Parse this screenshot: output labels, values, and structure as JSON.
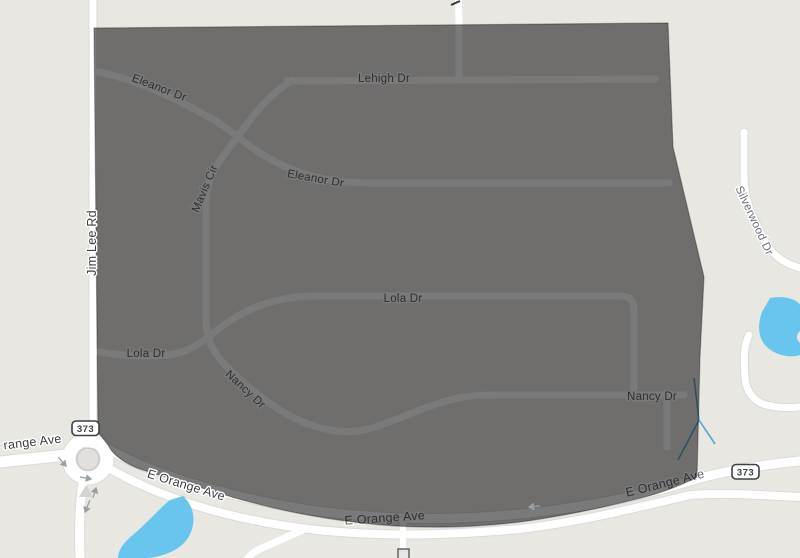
{
  "map": {
    "labels": {
      "eleanor1": {
        "text": "Eleanor Dr"
      },
      "lehigh": {
        "text": "Lehigh Dr"
      },
      "mavis": {
        "text": "Mavis Cir"
      },
      "eleanor2": {
        "text": "Eleanor Dr"
      },
      "jimlee": {
        "text": "Jim Lee Rd"
      },
      "silverwood": {
        "text": "Silverwood Dr"
      },
      "lola_main": {
        "text": "Lola Dr"
      },
      "lola_left": {
        "text": "Lola Dr"
      },
      "nancy_diag": {
        "text": "Nancy Dr"
      },
      "nancy_right": {
        "text": "Nancy Dr"
      },
      "orange_cut": {
        "text": "range Ave"
      },
      "eorange_sw": {
        "text": "E Orange Ave"
      },
      "eorange_mid": {
        "text": "E Orange Ave"
      },
      "eorange_e": {
        "text": "E Orange Ave"
      }
    },
    "badges": {
      "west": {
        "text": "373"
      },
      "east": {
        "text": "373"
      }
    },
    "colors": {
      "background": "#e9e7e2",
      "road": "#ffffff",
      "road_casing": "#dcdad6",
      "water": "#68c6ee",
      "stream": "#5aa7cc",
      "overlay_fill": "rgba(0,0,0,0.52)",
      "overlay_stroke": "rgba(0,0,0,0.30)",
      "inside_label": "#606368",
      "outside_label": "#3c3e43",
      "minor_outside_label": "#6d7075",
      "arrow": "#9aa0a6",
      "badge_border": "#3c4043"
    }
  }
}
